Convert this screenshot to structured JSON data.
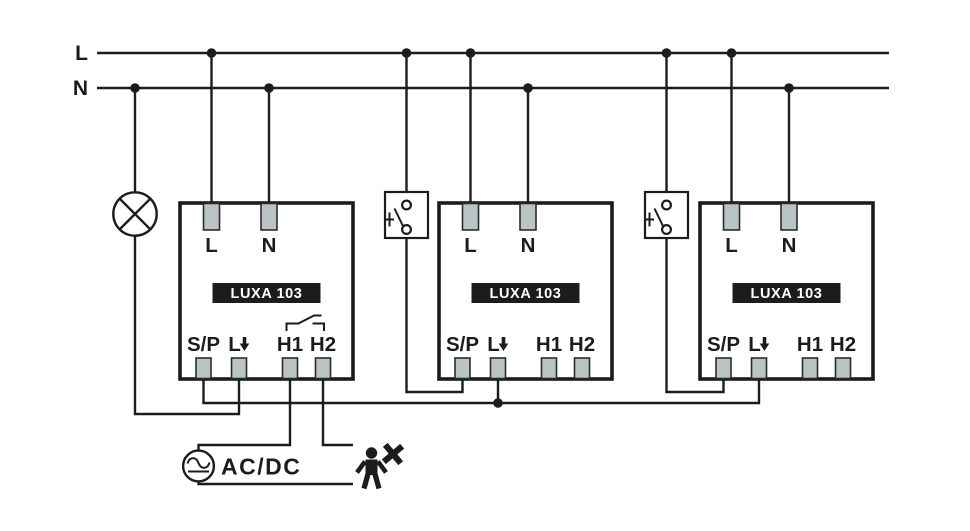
{
  "rails": {
    "live": "L",
    "neutral": "N"
  },
  "devices": [
    {
      "name": "LUXA 103",
      "top_terminals": [
        "L",
        "N"
      ],
      "bottom_terminals": [
        "S/P",
        "L",
        "H1",
        "H2"
      ]
    },
    {
      "name": "LUXA 103",
      "top_terminals": [
        "L",
        "N"
      ],
      "bottom_terminals": [
        "S/P",
        "L",
        "H1",
        "H2"
      ]
    },
    {
      "name": "LUXA 103",
      "top_terminals": [
        "L",
        "N"
      ],
      "bottom_terminals": [
        "S/P",
        "L",
        "H1",
        "H2"
      ]
    }
  ],
  "power_supply": {
    "label": "AC/DC"
  },
  "icons": {
    "lamp": "lamp-icon",
    "push_button_1": "push-button-icon",
    "push_button_2": "push-button-icon",
    "ac_dc_source": "ac-dc-source-icon",
    "person_motion": "person-motion-star-icon",
    "relay_contact": "relay-contact-icon",
    "down_arrow": "down-arrow-icon"
  },
  "colors": {
    "line": "#1c1c1c",
    "terminal_fill": "#b9c4c4",
    "device_label_bg": "#1b1b1b",
    "device_label_text": "#ffffff",
    "background": "#ffffff"
  }
}
